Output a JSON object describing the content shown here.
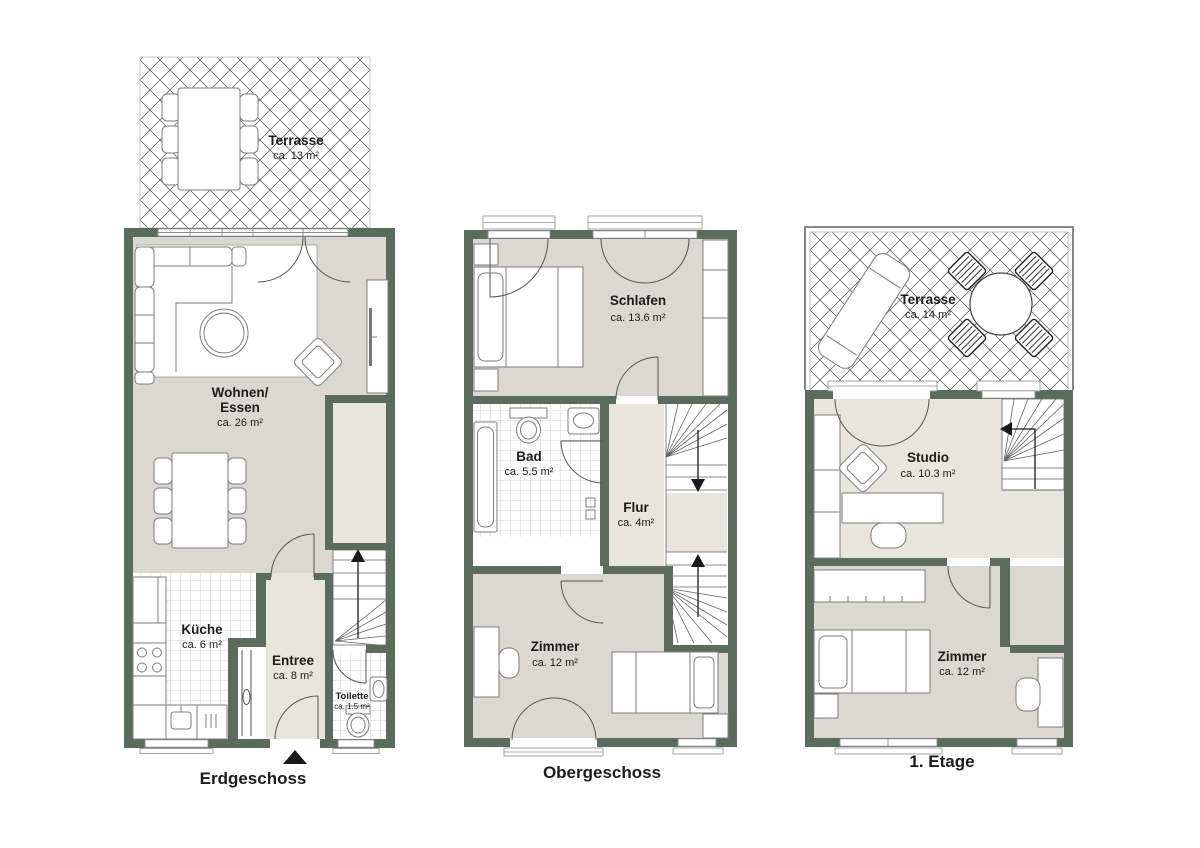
{
  "colors": {
    "wall": "#5a6c5e",
    "room_floor": "#dbd8d3",
    "hall_floor": "#e8e5df",
    "tile_line": "#c9c9c9",
    "outline": "#7d7d7d",
    "text": "#1c1c1c",
    "background": "#ffffff"
  },
  "plans": {
    "erdgeschoss": {
      "label": "Erdgeschoss",
      "rooms": {
        "terrasse": {
          "name": "Terrasse",
          "area": "ca. 13 m²"
        },
        "wohnen_essen": {
          "name_line1": "Wohnen/",
          "name_line2": "Essen",
          "area": "ca. 26 m²"
        },
        "kueche": {
          "name": "Küche",
          "area": "ca. 6 m²"
        },
        "entree": {
          "name": "Entree",
          "area": "ca. 8 m²"
        },
        "toilette": {
          "name": "Toilette",
          "area": "ca. 1.5 m²"
        }
      }
    },
    "obergeschoss": {
      "label": "Obergeschoss",
      "rooms": {
        "schlafen": {
          "name": "Schlafen",
          "area": "ca. 13.6 m²"
        },
        "bad": {
          "name": "Bad",
          "area": "ca. 5.5 m²"
        },
        "flur": {
          "name": "Flur",
          "area": "ca. 4m²"
        },
        "zimmer": {
          "name": "Zimmer",
          "area": "ca. 12 m²"
        }
      }
    },
    "etage1": {
      "label": "1. Etage",
      "rooms": {
        "terrasse": {
          "name": "Terrasse",
          "area": "ca. 14 m²"
        },
        "studio": {
          "name": "Studio",
          "area": "ca. 10.3 m²"
        },
        "zimmer": {
          "name": "Zimmer",
          "area": "ca. 12 m²"
        }
      }
    }
  }
}
